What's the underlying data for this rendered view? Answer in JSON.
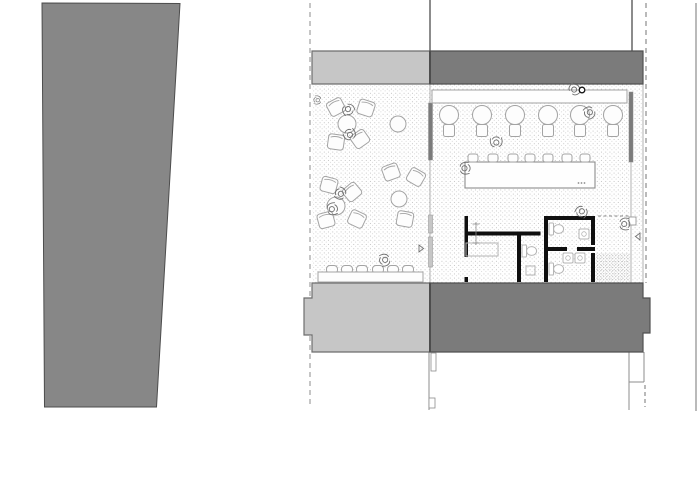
{
  "meta": {
    "description": "architectural-floor-plan",
    "scene": "cafe-ground-floor-plan-with-terrace-bar-and-restrooms"
  },
  "colors": {
    "paper": "#ffffff",
    "building_fill": "#878787",
    "building_stroke": "#4d4d4d",
    "band_light": "#c6c6c6",
    "band_light_stroke": "#6e6e6e",
    "band_dark": "#7b7b7b",
    "band_dark_stroke": "#515151",
    "wall_black": "#0f0f0f",
    "line": "#8c8c8c",
    "line_light": "#b2b2b2",
    "furniture": "#a3a3a3",
    "fixture": "#b5b5b5",
    "person": "#6f6f6f",
    "stipple": "#c3c3c3",
    "stipple_dense": "#9b9b9b"
  },
  "plan": {
    "building_polygon": "42,3 180,3.5 156.5,407 44.5,407",
    "floors": [
      {
        "name": "terrace-floor",
        "x": 312,
        "y": 85,
        "w": 118,
        "h": 198,
        "pattern": "pat-stipple"
      },
      {
        "name": "dining-floor",
        "x": 430,
        "y": 84,
        "w": 213,
        "h": 199,
        "pattern": "pat-stipple"
      },
      {
        "name": "entry-mat",
        "x": 596,
        "y": 253,
        "w": 34,
        "h": 29,
        "pattern": "pat-dense"
      }
    ],
    "guides": [
      {
        "name": "section-line-left",
        "x1": 310,
        "y1": 3,
        "x2": 310,
        "y2": 408,
        "dash": "5,4",
        "w": 1,
        "c": "line"
      },
      {
        "name": "section-line-right",
        "x1": 646,
        "y1": 3,
        "x2": 646,
        "y2": 283,
        "dash": "5,4",
        "w": 1.2,
        "c": "line"
      },
      {
        "name": "section-line-right-lower",
        "x1": 645,
        "y1": 385,
        "x2": 645,
        "y2": 407,
        "dash": "4,3",
        "w": 1.2,
        "c": "line"
      },
      {
        "name": "site-boundary-right",
        "x1": 696,
        "y1": 3,
        "x2": 696,
        "y2": 411,
        "w": 1.2,
        "c": "line"
      },
      {
        "name": "party-wall-upper-left",
        "x1": 430,
        "y1": 0,
        "x2": 430,
        "y2": 51,
        "w": 2,
        "c": "line"
      },
      {
        "name": "party-wall-upper-right",
        "x1": 632,
        "y1": 0,
        "x2": 632,
        "y2": 51,
        "w": 2,
        "c": "line"
      },
      {
        "name": "below-band-center",
        "x1": 429,
        "y1": 352,
        "x2": 429,
        "y2": 410,
        "w": 1,
        "c": "line"
      },
      {
        "name": "below-band-right-a",
        "x1": 629,
        "y1": 352,
        "x2": 629,
        "y2": 410,
        "w": 1,
        "c": "line"
      },
      {
        "name": "below-band-right-b",
        "x1": 644,
        "y1": 352,
        "x2": 644,
        "y2": 382,
        "w": 1,
        "c": "line"
      },
      {
        "name": "below-band-right-c",
        "x1": 629,
        "y1": 382,
        "x2": 644,
        "y2": 382,
        "w": 1,
        "c": "line"
      },
      {
        "name": "indoor-right-edge",
        "x1": 643,
        "y1": 84,
        "x2": 643,
        "y2": 283,
        "w": 1,
        "c": "line_light"
      },
      {
        "name": "storefront-thin-left",
        "x1": 430,
        "y1": 84,
        "x2": 430,
        "y2": 283,
        "w": 1,
        "c": "line_light"
      },
      {
        "name": "storefront-thin-right",
        "x1": 631,
        "y1": 162,
        "x2": 631,
        "y2": 283,
        "w": 1,
        "c": "line_light"
      }
    ],
    "bands": [
      {
        "name": "canopy-upper-left",
        "path": "M312,51 H430 V84 H312 Z",
        "fill": "band_light",
        "stroke": "band_light_stroke"
      },
      {
        "name": "canopy-upper-right",
        "path": "M430,51 H643 V84 H430 Z",
        "fill": "band_dark",
        "stroke": "band_dark_stroke"
      },
      {
        "name": "wall-band-lower-left",
        "path": "M312,283 H430 V352 H312 V335 H304 V298 H312 Z",
        "fill": "band_light",
        "stroke": "band_light_stroke"
      },
      {
        "name": "wall-band-lower-right",
        "path": "M430,283 H643 V298 H650 V333 H643 V352 H430 Z",
        "fill": "band_dark",
        "stroke": "band_dark_stroke"
      }
    ],
    "dividers": [
      {
        "name": "band-divider-top",
        "x1": 430,
        "y1": 51,
        "x2": 430,
        "y2": 84,
        "w": 2,
        "c": "building_stroke"
      },
      {
        "name": "band-divider-bottom",
        "x1": 430,
        "y1": 283,
        "x2": 430,
        "y2": 352,
        "w": 2,
        "c": "building_stroke"
      },
      {
        "name": "entry-threshold-dashed",
        "x1": 598,
        "y1": 216,
        "x2": 629,
        "y2": 216,
        "dash": "3,2.5",
        "w": 1,
        "c": "line"
      }
    ],
    "mullions": [
      {
        "name": "storefront-mullion-left",
        "x": 428.5,
        "y": 103,
        "w": 4,
        "h": 57,
        "fill": "band_dark"
      },
      {
        "name": "storefront-mullion-right",
        "x": 629,
        "y": 92,
        "w": 4,
        "h": 70,
        "fill": "band_dark"
      },
      {
        "name": "terrace-door-left-a",
        "x": 428.5,
        "y": 215,
        "w": 4,
        "h": 18,
        "fill": "band_light"
      },
      {
        "name": "terrace-door-left-b",
        "x": 428.5,
        "y": 237,
        "w": 4,
        "h": 30,
        "fill": "band_light"
      }
    ],
    "detail_rects": [
      {
        "name": "jamb-detail-a",
        "x": 431,
        "y": 353,
        "w": 5,
        "h": 18
      },
      {
        "name": "jamb-detail-b",
        "x": 429,
        "y": 398,
        "w": 6,
        "h": 10
      },
      {
        "name": "entry-post",
        "x": 629,
        "y": 217,
        "w": 7,
        "h": 8
      },
      {
        "name": "counter-item",
        "x": 449,
        "y": 92,
        "w": 6,
        "h": 5
      },
      {
        "name": "counter-item",
        "x": 500,
        "y": 92,
        "w": 7,
        "h": 4
      }
    ],
    "counter": {
      "x": 432,
      "y": 90,
      "w": 195,
      "h": 13
    },
    "island_table": {
      "x": 465,
      "y": 162,
      "w": 130,
      "h": 26
    },
    "island_dots": [
      [
        578.5,
        183
      ],
      [
        581.5,
        183
      ],
      [
        584.5,
        183
      ]
    ],
    "bench": {
      "x": 318,
      "y": 272,
      "w": 105,
      "h": 10
    },
    "bench_seats_cx": [
      332,
      347,
      362,
      378,
      393,
      408
    ],
    "dining_sets_cx": [
      449,
      482,
      515,
      548,
      580,
      613
    ],
    "stools_cx": [
      473,
      493,
      513,
      530,
      548,
      567,
      585
    ],
    "round_tables": [
      {
        "cx": 347,
        "cy": 124,
        "r": 9
      },
      {
        "cx": 398,
        "cy": 124,
        "r": 8
      },
      {
        "cx": 336,
        "cy": 206,
        "r": 9
      },
      {
        "cx": 399,
        "cy": 199,
        "r": 8
      }
    ],
    "terrace_chairs": [
      {
        "x": 336,
        "y": 107,
        "r": -28
      },
      {
        "x": 366,
        "y": 108,
        "r": 18
      },
      {
        "x": 336,
        "y": 142,
        "r": 8
      },
      {
        "x": 360,
        "y": 139,
        "r": -35
      },
      {
        "x": 329,
        "y": 185,
        "r": 15
      },
      {
        "x": 352,
        "y": 192,
        "r": -40
      },
      {
        "x": 326,
        "y": 220,
        "r": -15
      },
      {
        "x": 357,
        "y": 219,
        "r": 25
      },
      {
        "x": 391,
        "y": 172,
        "r": -20
      },
      {
        "x": 416,
        "y": 177,
        "r": 30
      },
      {
        "x": 405,
        "y": 219,
        "r": 10
      }
    ],
    "black_walls": [
      {
        "x": 464.5,
        "y": 216,
        "w": 3.5,
        "h": 41
      },
      {
        "x": 464.5,
        "y": 231.5,
        "w": 76,
        "h": 4
      },
      {
        "x": 517,
        "y": 235.5,
        "w": 4,
        "h": 46.5
      },
      {
        "x": 544,
        "y": 216,
        "w": 51,
        "h": 4
      },
      {
        "x": 544,
        "y": 216,
        "w": 4,
        "h": 66
      },
      {
        "x": 544,
        "y": 247,
        "w": 23,
        "h": 4
      },
      {
        "x": 577,
        "y": 247,
        "w": 18,
        "h": 4
      },
      {
        "x": 591,
        "y": 216,
        "w": 4,
        "h": 29
      },
      {
        "x": 591,
        "y": 253,
        "w": 4,
        "h": 29
      },
      {
        "x": 464.5,
        "y": 277,
        "w": 3.5,
        "h": 5
      }
    ],
    "toilets": [
      {
        "x": 549,
        "y": 223
      },
      {
        "x": 549,
        "y": 263
      },
      {
        "x": 522,
        "y": 245
      }
    ],
    "sinks": [
      {
        "x": 579,
        "y": 229
      },
      {
        "x": 563,
        "y": 253
      },
      {
        "x": 575,
        "y": 253
      }
    ],
    "fixture_rects": [
      {
        "name": "vanity-counter",
        "x": 466,
        "y": 243,
        "w": 32,
        "h": 13
      },
      {
        "name": "wc-shelf",
        "x": 526,
        "y": 266,
        "w": 9,
        "h": 9
      }
    ],
    "fixture_lines": [
      {
        "x1": 476,
        "y1": 222,
        "x2": 476,
        "y2": 245
      },
      {
        "x1": 472.5,
        "y1": 224,
        "x2": 479.5,
        "y2": 224
      },
      {
        "x1": 472.5,
        "y1": 243,
        "x2": 479.5,
        "y2": 243
      }
    ],
    "people": [
      {
        "x": 337,
        "y": 106,
        "r": -30
      },
      {
        "x": 361,
        "y": 138,
        "r": 150
      },
      {
        "x": 352,
        "y": 191,
        "r": 120
      },
      {
        "x": 326,
        "y": 219,
        "r": -105
      },
      {
        "x": 391,
        "y": 250,
        "r": 75
      },
      {
        "x": 457,
        "y": 177,
        "r": -95
      },
      {
        "x": 505,
        "y": 150,
        "r": 175
      },
      {
        "x": 580,
        "y": 200,
        "r": 35
      },
      {
        "x": 573,
        "y": 101,
        "r": -130
      },
      {
        "x": 592,
        "y": 101,
        "r": 55
      },
      {
        "x": 616,
        "y": 232,
        "r": -90
      },
      {
        "x": 324,
        "y": 95,
        "r": 95,
        "s": 0.7
      }
    ],
    "triangles": [
      {
        "name": "entry-arrow",
        "points": "640,233 640,240 635.5,236.5"
      },
      {
        "name": "terrace-arrow",
        "points": "419,245 419,252 423.5,248.5"
      }
    ],
    "circle_marker": {
      "cx": 582,
      "cy": 90,
      "r": 2.8
    }
  }
}
